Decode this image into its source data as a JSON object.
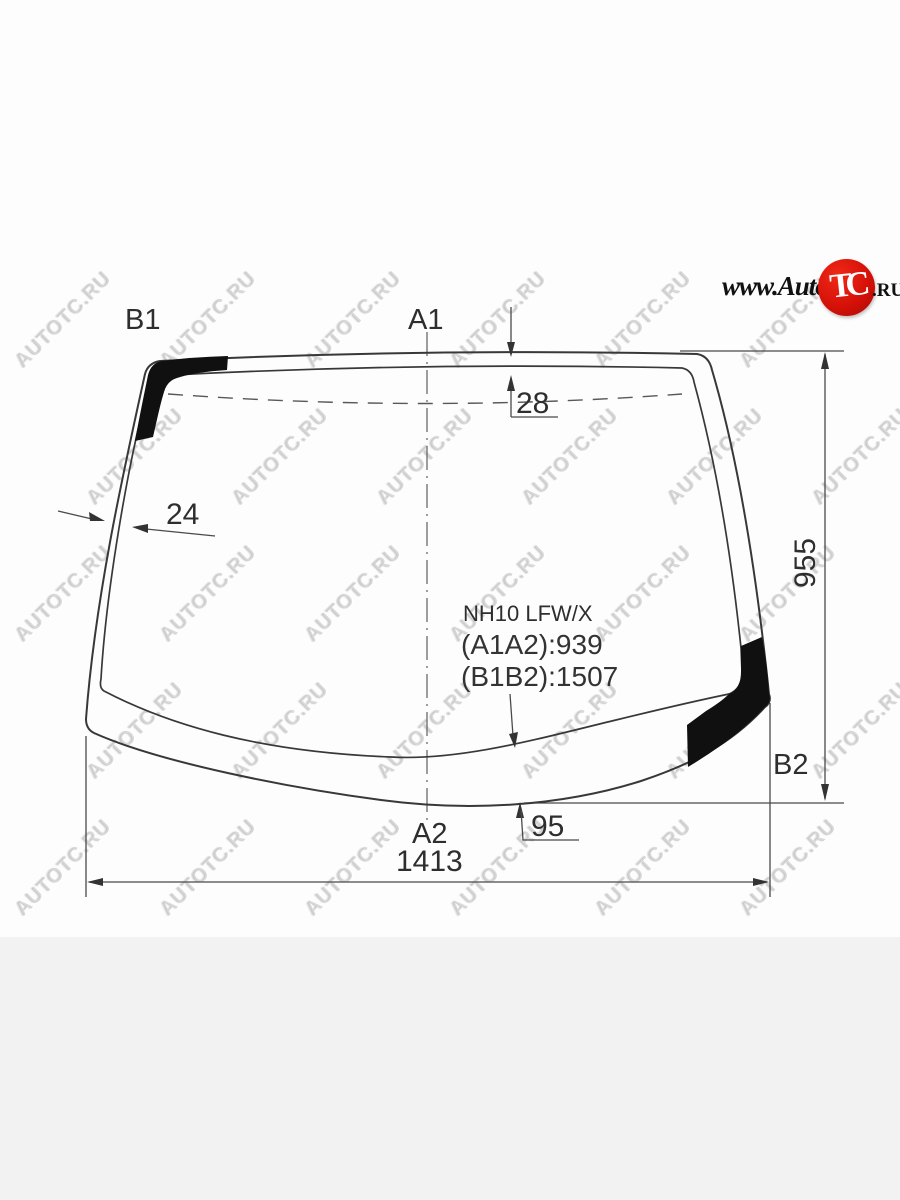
{
  "page": {
    "background_top": "#fdfdfd",
    "background_footer": "#f1f2f1"
  },
  "logo": {
    "prefix": "www.Auto",
    "badge": "TC",
    "suffix": ".RU",
    "badge_color": "#d61108"
  },
  "watermark": {
    "text": "AUTOTC.RU",
    "rows": [
      {
        "y": 320,
        "xs": [
          64,
          209,
          354,
          499,
          644,
          789
        ]
      },
      {
        "y": 457,
        "xs": [
          136,
          281,
          426,
          571,
          716,
          861
        ]
      },
      {
        "y": 594,
        "xs": [
          64,
          209,
          354,
          499,
          644,
          789
        ]
      },
      {
        "y": 731,
        "xs": [
          136,
          281,
          426,
          571,
          716,
          861
        ]
      },
      {
        "y": 868,
        "xs": [
          64,
          209,
          354,
          499,
          644,
          789
        ]
      }
    ]
  },
  "diagram": {
    "point_labels": {
      "b1": "B1",
      "a1": "A1",
      "a2": "A2",
      "b2": "B2"
    },
    "dimensions": {
      "top_band_width": "28",
      "left_band_width": "24",
      "glass_height": "955",
      "bottom_band_width": "95",
      "glass_width": "1413"
    },
    "part_info": {
      "code": "NH10 LFW/X",
      "a1a2": "(A1A2):939",
      "b1b2": "(B1B2):1507"
    },
    "colors": {
      "outline": "#383838",
      "dimension_lines": "#4a4a4a",
      "frit_band": "#101010"
    }
  }
}
